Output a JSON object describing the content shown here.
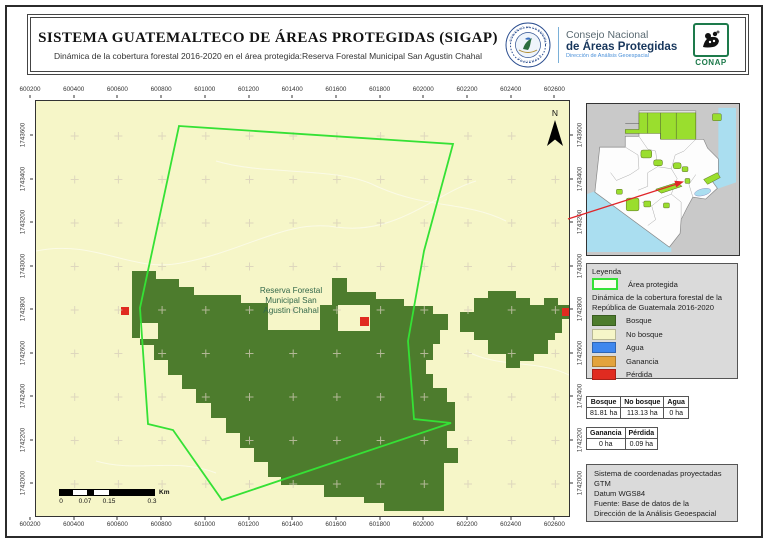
{
  "header": {
    "title": "SISTEMA GUATEMALTECO DE ÁREAS PROTEGIDAS  (SIGAP)",
    "subtitle": "Dinámica de la cobertura forestal 2016-2020 en el área protegida:Reserva Forestal Municipal San Agustin Chahal",
    "seal_top": "GOBIERNO DE LA REPÚBLICA",
    "seal_bottom": "GUATEMALA",
    "org_line1": "Consejo Nacional",
    "org_line2": "de Áreas Protegidas",
    "org_line3": "Dirección de Análisis Geoespacial",
    "conap_label": "CONAP"
  },
  "map": {
    "north_label": "N",
    "reserve_label_lines": [
      "Reserva Forestal",
      "Municipal San",
      "Agustin Chahal"
    ],
    "x_ticks": [
      "600200",
      "600400",
      "600600",
      "600800",
      "601000",
      "601200",
      "601400",
      "601600",
      "601800",
      "602000",
      "602200",
      "602400",
      "602600"
    ],
    "y_ticks": [
      "1743600",
      "1743400",
      "1743200",
      "1743000",
      "1742800",
      "1742600",
      "1742400",
      "1742200",
      "1742000"
    ],
    "scalebar": {
      "labels": [
        "0",
        "0.07",
        "0.15",
        "0.3"
      ],
      "unit": "Km"
    }
  },
  "legend": {
    "title": "Leyenda",
    "area_item": "Área protegida",
    "subtitle": "Dinámica de la cobertura forestal de la República de Guatemala 2016-2020",
    "items": [
      {
        "label": "Bosque",
        "color": "#4d7c2d"
      },
      {
        "label": "No bosque",
        "color": "#f6f6c8"
      },
      {
        "label": "Agua",
        "color": "#3f87ee"
      },
      {
        "label": "Ganancia",
        "color": "#e3a33c"
      },
      {
        "label": "Pérdida",
        "color": "#e02b20"
      }
    ]
  },
  "tables": {
    "coverage": {
      "headers": [
        "Bosque",
        "No bosque",
        "Agua"
      ],
      "values": [
        "81.81 ha",
        "113.13 ha",
        "0 ha"
      ]
    },
    "change": {
      "headers": [
        "Ganancia",
        "Pérdida"
      ],
      "values": [
        "0 ha",
        "0.09 ha"
      ]
    }
  },
  "credits": {
    "lines": [
      "Sistema de coordenadas proyectadas",
      "GTM",
      "Datum WGS84",
      "Fuente: Base de datos de la",
      "Dirección de la Análisis Geoespacial"
    ]
  },
  "colors": {
    "forest": "#4d7c2d",
    "mapbg": "#f6f6c8",
    "bound": "#35e135",
    "agua": "#3f87ee",
    "ganancia": "#e3a33c",
    "perdida": "#e02b20",
    "insetgreen": "#9ade2e",
    "water": "#aadef0",
    "panel": "#dadada",
    "insetbg": "#c9c9c9",
    "navy": "#17365c",
    "blue": "#4a90d9",
    "conap": "#1d7a4b",
    "redline": "#e0252a",
    "maplabel": "#33684a"
  }
}
